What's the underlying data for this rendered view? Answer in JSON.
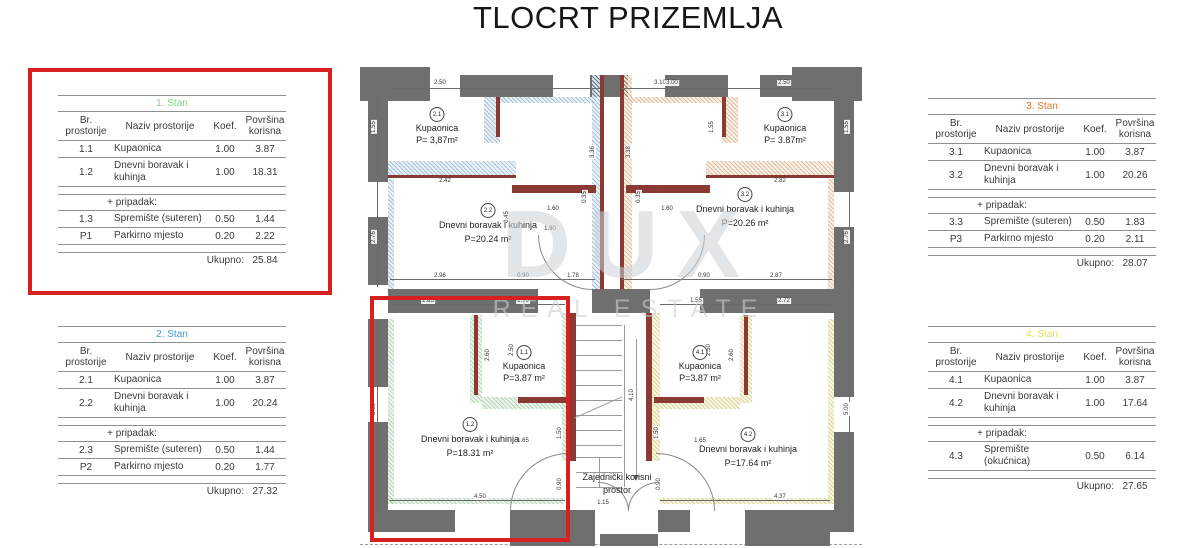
{
  "title": "TLOCRT PRIZEMLJA",
  "colors": {
    "highlight_red": "#d92020",
    "wall_gray": "#6f6f6f",
    "wall_brick": "#8a3a33",
    "stan1_green": "#7fd67f",
    "stan2_blue": "#3d9bd5",
    "stan3_orange": "#df7428",
    "stan4_yellow": "#e3df52"
  },
  "tables": [
    {
      "title": "1. Stan",
      "color": "#7fd67f",
      "headers": [
        "Br. prostorije",
        "Naziv prostorije",
        "Koef.",
        "Površina korisna"
      ],
      "rows": [
        {
          "type": "data",
          "id": "1.1",
          "name": "Kupaonica",
          "koef": "1.00",
          "area": "3.87"
        },
        {
          "type": "data",
          "id": "1.2",
          "name": "Dnevni boravak i kuhinja",
          "koef": "1.00",
          "area": "18.31"
        },
        {
          "type": "spacer"
        },
        {
          "type": "section",
          "label": "+ pripadak:"
        },
        {
          "type": "data",
          "id": "1.3",
          "name": "Spremište (suteren)",
          "koef": "0.50",
          "area": "1.44"
        },
        {
          "type": "data",
          "id": "P1",
          "name": "Parkirno mjesto",
          "koef": "0.20",
          "area": "2.22"
        },
        {
          "type": "spacer"
        },
        {
          "type": "total",
          "label": "Ukupno:",
          "value": "25.84"
        }
      ]
    },
    {
      "title": "2. Stan",
      "color": "#3d9bd5",
      "headers": [
        "Br. prostorije",
        "Naziv prostorije",
        "Koef.",
        "Površina korisna"
      ],
      "rows": [
        {
          "type": "data",
          "id": "2.1",
          "name": "Kupaonica",
          "koef": "1.00",
          "area": "3.87"
        },
        {
          "type": "data",
          "id": "2.2",
          "name": "Dnevni boravak i kuhinja",
          "koef": "1.00",
          "area": "20.24"
        },
        {
          "type": "spacer"
        },
        {
          "type": "section",
          "label": "+ pripadak:"
        },
        {
          "type": "data",
          "id": "2.3",
          "name": "Spremište (suteren)",
          "koef": "0.50",
          "area": "1.44"
        },
        {
          "type": "data",
          "id": "P2",
          "name": "Parkirno mjesto",
          "koef": "0.20",
          "area": "1.77"
        },
        {
          "type": "spacer"
        },
        {
          "type": "total",
          "label": "Ukupno:",
          "value": "27.32"
        }
      ]
    },
    {
      "title": "3. Stan",
      "color": "#df7428",
      "headers": [
        "Br. prostorije",
        "Naziv prostorije",
        "Koef.",
        "Površina korisna"
      ],
      "rows": [
        {
          "type": "data",
          "id": "3.1",
          "name": "Kupaonica",
          "koef": "1.00",
          "area": "3.87"
        },
        {
          "type": "data",
          "id": "3.2",
          "name": "Dnevni boravak i kuhinja",
          "koef": "1.00",
          "area": "20.26"
        },
        {
          "type": "spacer"
        },
        {
          "type": "section",
          "label": "+ pripadak:"
        },
        {
          "type": "data",
          "id": "3.3",
          "name": "Spremište (suteren)",
          "koef": "0.50",
          "area": "1.83"
        },
        {
          "type": "data",
          "id": "P3",
          "name": "Parkirno mjesto",
          "koef": "0.20",
          "area": "2.11"
        },
        {
          "type": "spacer"
        },
        {
          "type": "total",
          "label": "Ukupno:",
          "value": "28.07"
        }
      ]
    },
    {
      "title": "4. Stan",
      "color": "#e3df52",
      "headers": [
        "Br. prostorije",
        "Naziv prostorije",
        "Koef.",
        "Površina korisna"
      ],
      "rows": [
        {
          "type": "data",
          "id": "4.1",
          "name": "Kupaonica",
          "koef": "1.00",
          "area": "3.87"
        },
        {
          "type": "data",
          "id": "4.2",
          "name": "Dnevni boravak i kuhinja",
          "koef": "1.00",
          "area": "17.64"
        },
        {
          "type": "spacer"
        },
        {
          "type": "section",
          "label": "+ pripadak:"
        },
        {
          "type": "data",
          "id": "4.3",
          "name": "Spremište (okućnica)",
          "koef": "0.50",
          "area": "6.14"
        },
        {
          "type": "spacer"
        },
        {
          "type": "total",
          "label": "Ukupno:",
          "value": "27.65"
        }
      ]
    }
  ],
  "plan": {
    "watermark": {
      "line1": "DUX",
      "line2": "REAL ESTATE"
    },
    "common_area": {
      "line1": "Zajednički korisni",
      "line2": "prostor"
    },
    "rooms": {
      "u2_bath": {
        "num": "2.1",
        "name": "Kupaonica",
        "area": "P= 3,87m²"
      },
      "u2_living": {
        "num": "2.2",
        "name": "Dnevni boravak i kuhinja",
        "area": "P=20.24 m²"
      },
      "u3_bath": {
        "num": "3.1",
        "name": "Kupaonica",
        "area": "P= 3.87m²"
      },
      "u3_living": {
        "num": "3.2",
        "name": "Dnevni boravak i kuhinja",
        "area": "P=20.26 m²"
      },
      "u1_bath": {
        "num": "1.1",
        "name": "Kupaonica",
        "area": "P=3.87 m²"
      },
      "u1_living": {
        "num": "1.2",
        "name": "Dnevni boravak i kuhinja",
        "area": "P=18.31 m²"
      },
      "u4_bath": {
        "num": "4.1",
        "name": "Kupaonica",
        "area": "P=3.87 m²"
      },
      "u4_living": {
        "num": "4.2",
        "name": "Dnevni boravak i kuhinja",
        "area": "P=17.64 m²"
      }
    },
    "dimensions": [
      {
        "t": "2.50",
        "x": 80,
        "y": 26
      },
      {
        "t": "3.10",
        "x": 300,
        "y": 26
      },
      {
        "t": "1.55",
        "x": 14,
        "y": 70,
        "v": 1
      },
      {
        "t": "2.42",
        "x": 85,
        "y": 124
      },
      {
        "t": "3.36",
        "x": 233,
        "y": 95,
        "v": 1
      },
      {
        "t": "0.35",
        "x": 225,
        "y": 140,
        "v": 1
      },
      {
        "t": "1.60",
        "x": 193,
        "y": 152
      },
      {
        "t": "0.45",
        "x": 147,
        "y": 160,
        "v": 1
      },
      {
        "t": "1.90",
        "x": 190,
        "y": 172
      },
      {
        "t": "2.76",
        "x": 14,
        "y": 180,
        "v": 1
      },
      {
        "t": "2.96",
        "x": 80,
        "y": 219
      },
      {
        "t": "0.90",
        "x": 163,
        "y": 219
      },
      {
        "t": "1.78",
        "x": 213,
        "y": 219
      },
      {
        "t": "3.00",
        "x": 312,
        "y": 26
      },
      {
        "t": "2.50",
        "x": 424,
        "y": 26
      },
      {
        "t": "1.55",
        "x": 352,
        "y": 70,
        "v": 1
      },
      {
        "t": "1.55",
        "x": 487,
        "y": 70,
        "v": 1
      },
      {
        "t": "2.82",
        "x": 420,
        "y": 124
      },
      {
        "t": "3.38",
        "x": 269,
        "y": 95,
        "v": 1
      },
      {
        "t": "0.35",
        "x": 279,
        "y": 140,
        "v": 1
      },
      {
        "t": "1.60",
        "x": 307,
        "y": 152
      },
      {
        "t": "2.76",
        "x": 487,
        "y": 180,
        "v": 1
      },
      {
        "t": "0.90",
        "x": 344,
        "y": 219
      },
      {
        "t": "2.87",
        "x": 416,
        "y": 219
      },
      {
        "t": "2.85",
        "x": 68,
        "y": 244
      },
      {
        "t": "1.55",
        "x": 163,
        "y": 244
      },
      {
        "t": "2.60",
        "x": 128,
        "y": 298,
        "v": 1
      },
      {
        "t": "2.50",
        "x": 152,
        "y": 293,
        "v": 1
      },
      {
        "t": "5.00",
        "x": 14,
        "y": 352,
        "v": 1
      },
      {
        "t": "1.65",
        "x": 163,
        "y": 384
      },
      {
        "t": "1.50",
        "x": 200,
        "y": 376,
        "v": 1
      },
      {
        "t": "0.90",
        "x": 200,
        "y": 427,
        "v": 1
      },
      {
        "t": "4.50",
        "x": 120,
        "y": 440
      },
      {
        "t": "1.55",
        "x": 336,
        "y": 244
      },
      {
        "t": "2.72",
        "x": 424,
        "y": 244
      },
      {
        "t": "2.50",
        "x": 349,
        "y": 293,
        "v": 1
      },
      {
        "t": "2.60",
        "x": 372,
        "y": 298,
        "v": 1
      },
      {
        "t": "5.00",
        "x": 487,
        "y": 352,
        "v": 1
      },
      {
        "t": "1.65",
        "x": 340,
        "y": 384
      },
      {
        "t": "1.50",
        "x": 297,
        "y": 376,
        "v": 1
      },
      {
        "t": "0.90",
        "x": 299,
        "y": 427,
        "v": 1
      },
      {
        "t": "4.37",
        "x": 420,
        "y": 440
      },
      {
        "t": "4.10",
        "x": 272,
        "y": 338,
        "v": 1
      },
      {
        "t": "1.15",
        "x": 243,
        "y": 446
      }
    ]
  }
}
